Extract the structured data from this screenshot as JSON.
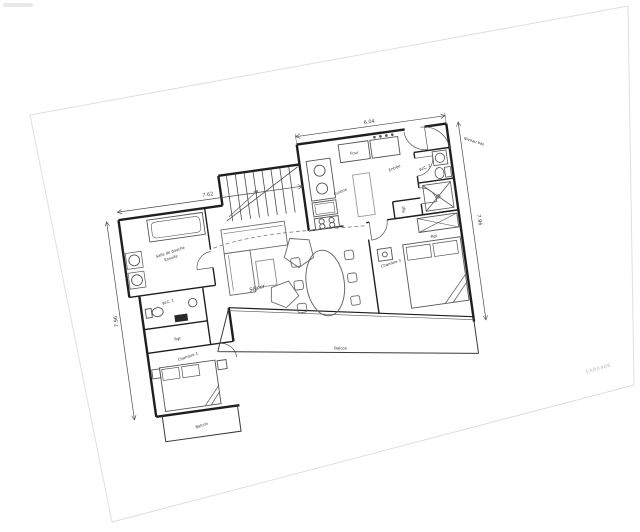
{
  "plan": {
    "labels": {
      "cuisine": "Cuisine",
      "entree": "Entrée",
      "four": "Four",
      "wc2": "W.C. 2",
      "rgt_kitchen": "Rgt",
      "sejour": "Séjour",
      "chambre3": "Chambre 3",
      "rgt_chambre3": "Rgt",
      "chambre1": "Chambre 1",
      "wc1": "W.C. 1",
      "rgt_wc": "Rgt",
      "douche_line1": "Salle de douche",
      "douche_line2": "Ensuite",
      "balcon_main": "Balcon",
      "balcon_left": "Balcon"
    },
    "dims": {
      "top": "6.04",
      "left_top": "7.62",
      "right": "7.96",
      "left": "7.96",
      "niveau": "Niveau bas"
    },
    "colors": {
      "wall": "#1f1f1f",
      "furniture": "#6a6a6a",
      "dimension": "#4a4a4a",
      "paper_edge": "#dbe0e6"
    }
  },
  "watermark": {
    "edge_code": "FAR0406"
  }
}
